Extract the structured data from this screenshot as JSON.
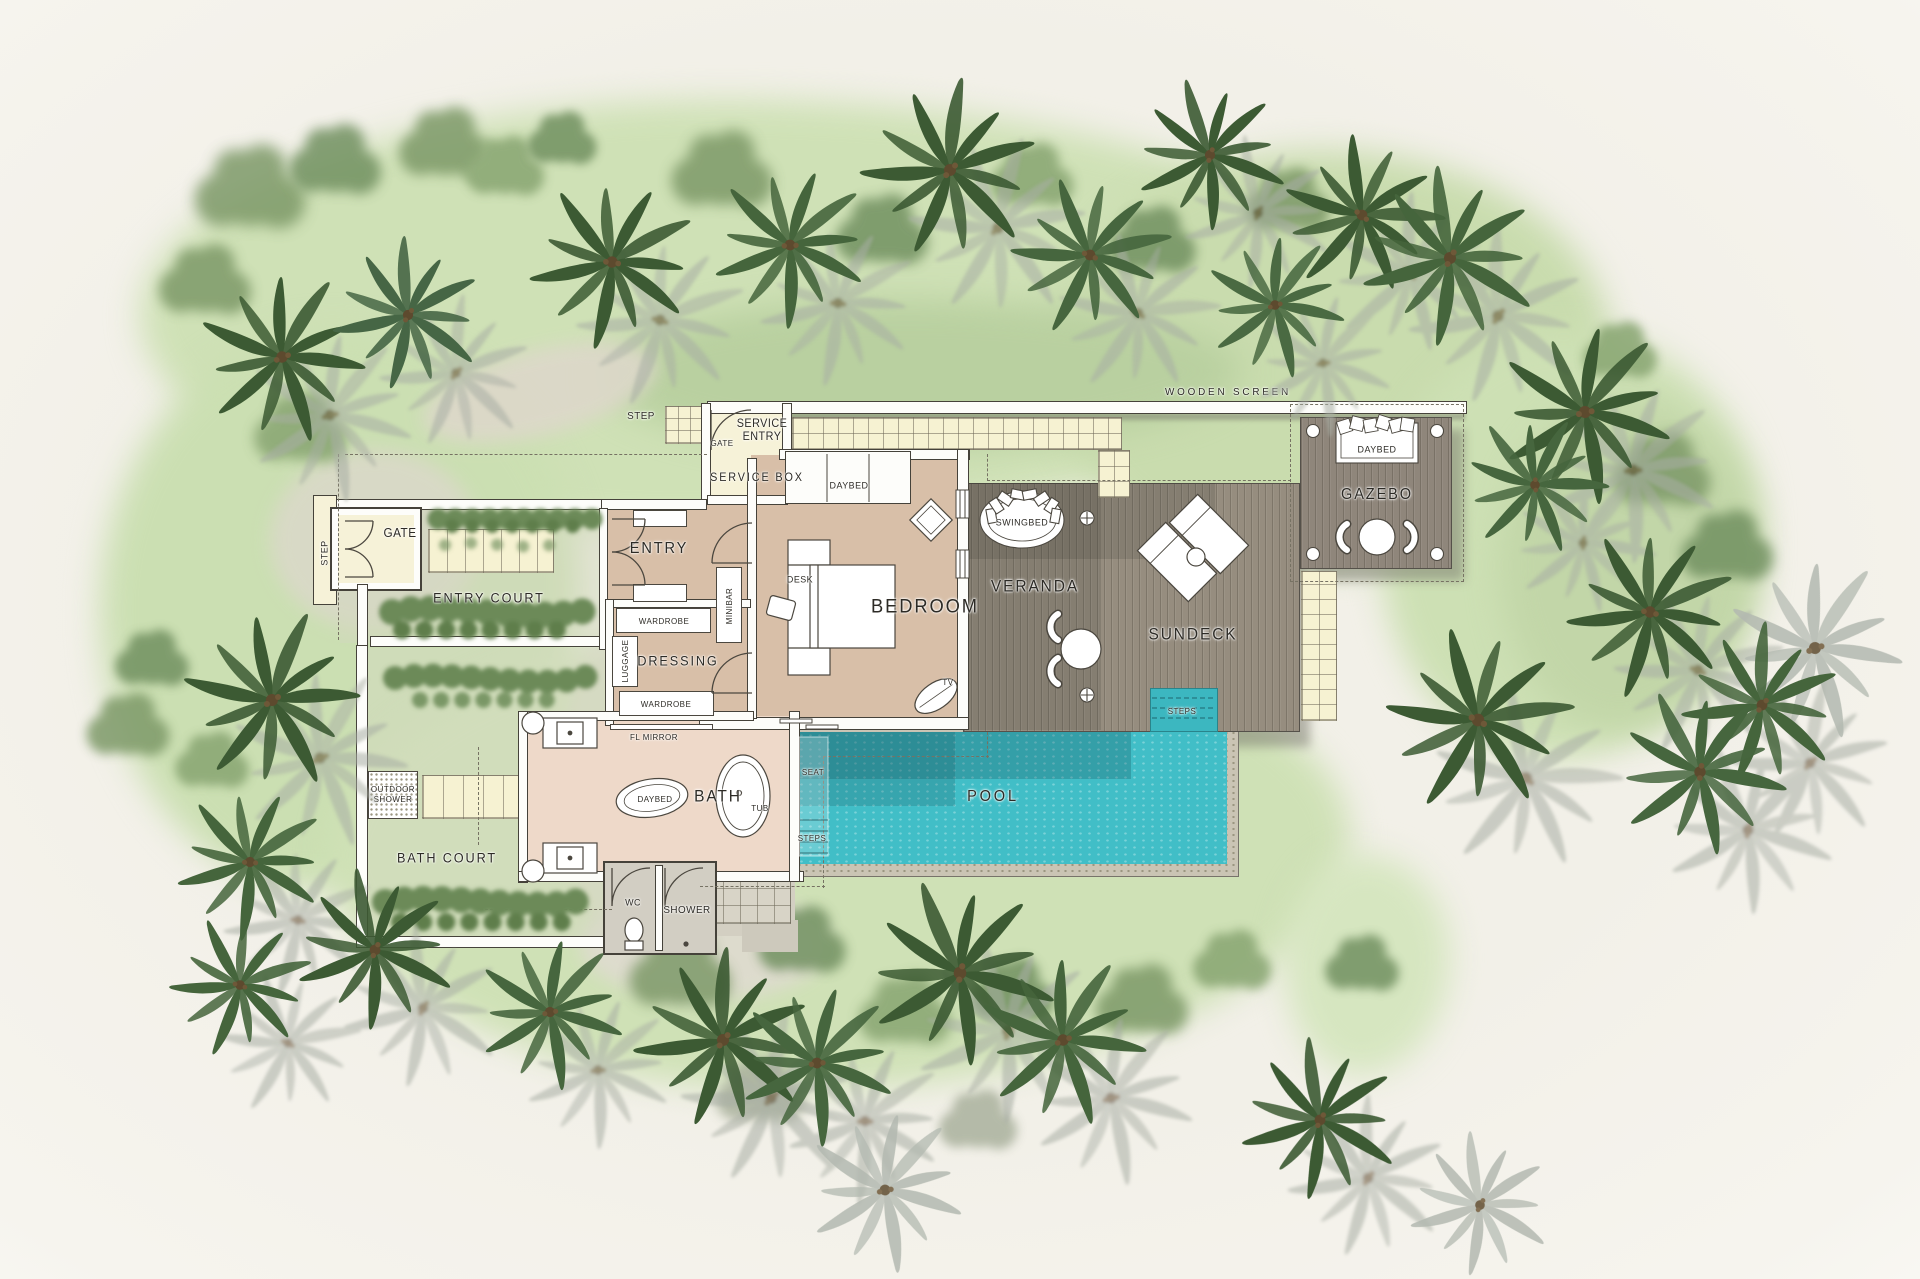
{
  "labels": {
    "step_top": "STEP",
    "service_gate": "GATE",
    "service_entry": "SERVICE ENTRY",
    "service_box": "SERVICE BOX",
    "wooden_screen": "WOODEN SCREEN",
    "gate": "GATE",
    "step_gate": "STEP",
    "entry_court": "ENTRY COURT",
    "entry": "ENTRY",
    "minibar": "MINIBAR",
    "wardrobe_1": "WARDROBE",
    "dressing": "DRESSING",
    "luggage": "LUGGAGE",
    "wardrobe_2": "WARDROBE",
    "fl_mirror": "FL MIRROR",
    "daybed_bedroom": "DAYBED",
    "desk": "DESK",
    "bedroom": "BEDROOM",
    "tv": "TV",
    "swingbed": "SWINGBED",
    "veranda": "VERANDA",
    "sundeck": "SUNDECK",
    "steps_sundeck": "STEPS",
    "gazebo_daybed": "DAYBED",
    "gazebo": "GAZEBO",
    "pool": "POOL",
    "seat": "SEAT",
    "steps_pool": "STEPS",
    "bath_daybed": "DAYBED",
    "bath": "BATH",
    "tub": "TUB",
    "outdoor_shower": "OUTDOOR SHOWER",
    "bath_court": "BATH COURT",
    "wc": "WC",
    "shower": "SHOWER"
  },
  "colors": {
    "background": "#f2f0e8",
    "lawn": "#cfe1b6",
    "lawn_dark": "#b9d0a0",
    "deck_wood": "#968d7f",
    "gazebo_wood": "#8f867b",
    "pool_water": "#41bec7",
    "pool_shadow": "#16505880",
    "pool_stone": "#cac4b4",
    "floor_bedroom": "#d8bfa8",
    "floor_bath": "#eed9c9",
    "floor_service": "#f6f2d8",
    "paving_squares": "#f6f2d2",
    "wall_fill": "#fdfdfa",
    "wall_line": "#45423a",
    "palm_green": "#3c5a33",
    "palm_shadow": "#a8aea4",
    "hedge_green": "#5f7e4b",
    "label_ink": "#2d2b26"
  }
}
